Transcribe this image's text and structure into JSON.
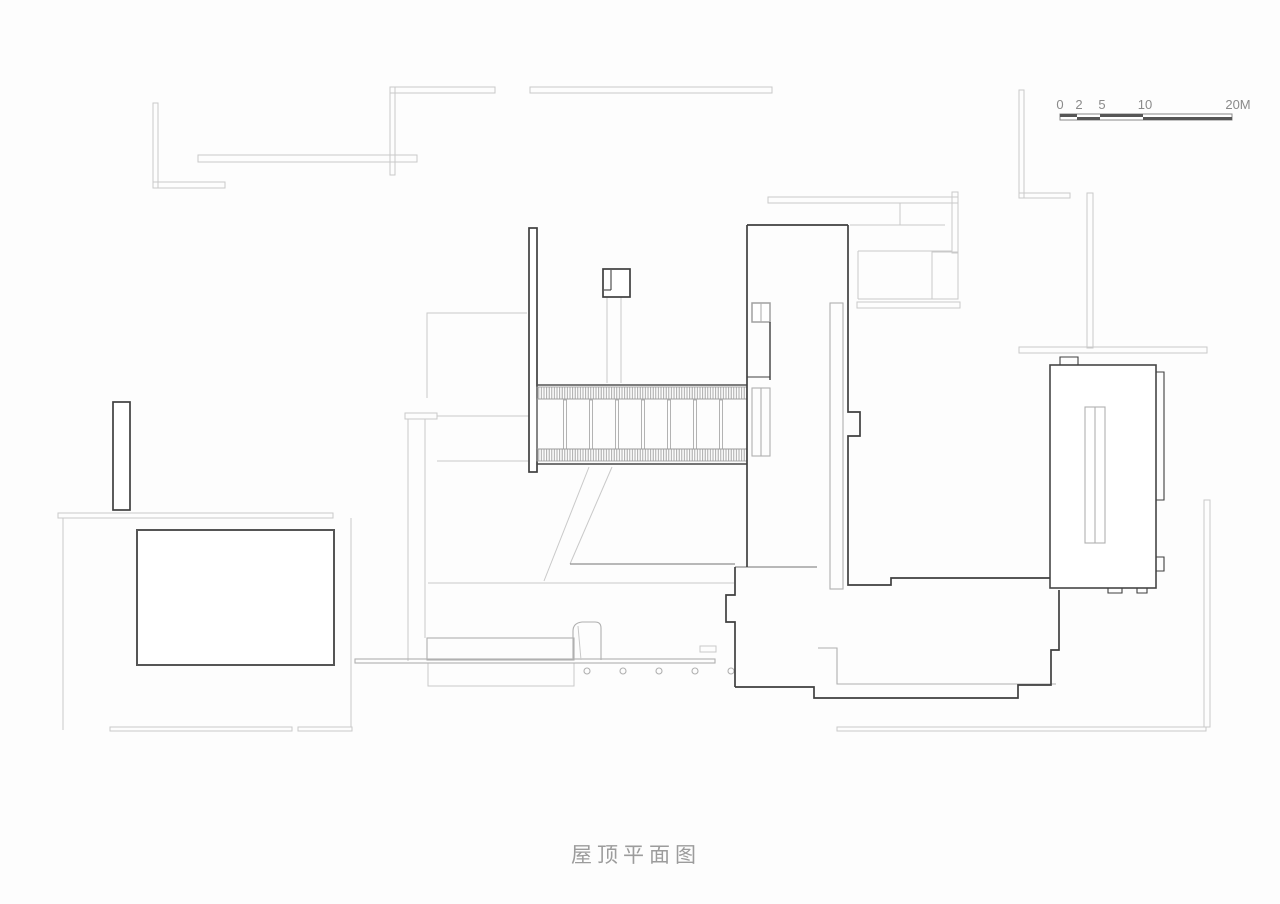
{
  "title": {
    "text": "屋顶平面图"
  },
  "scale_bar": {
    "labels": [
      "0",
      "2",
      "5",
      "10",
      "20M"
    ]
  },
  "colors": {
    "line-dark": "#3f3f3f",
    "line-mid": "#8f8f8f",
    "line-gray": "#b0b0b0",
    "line-light": "#c9c9c9",
    "text-muted": "#9c9c9c",
    "scale-text": "#8a8a8a",
    "bg": "#fdfdfd"
  }
}
